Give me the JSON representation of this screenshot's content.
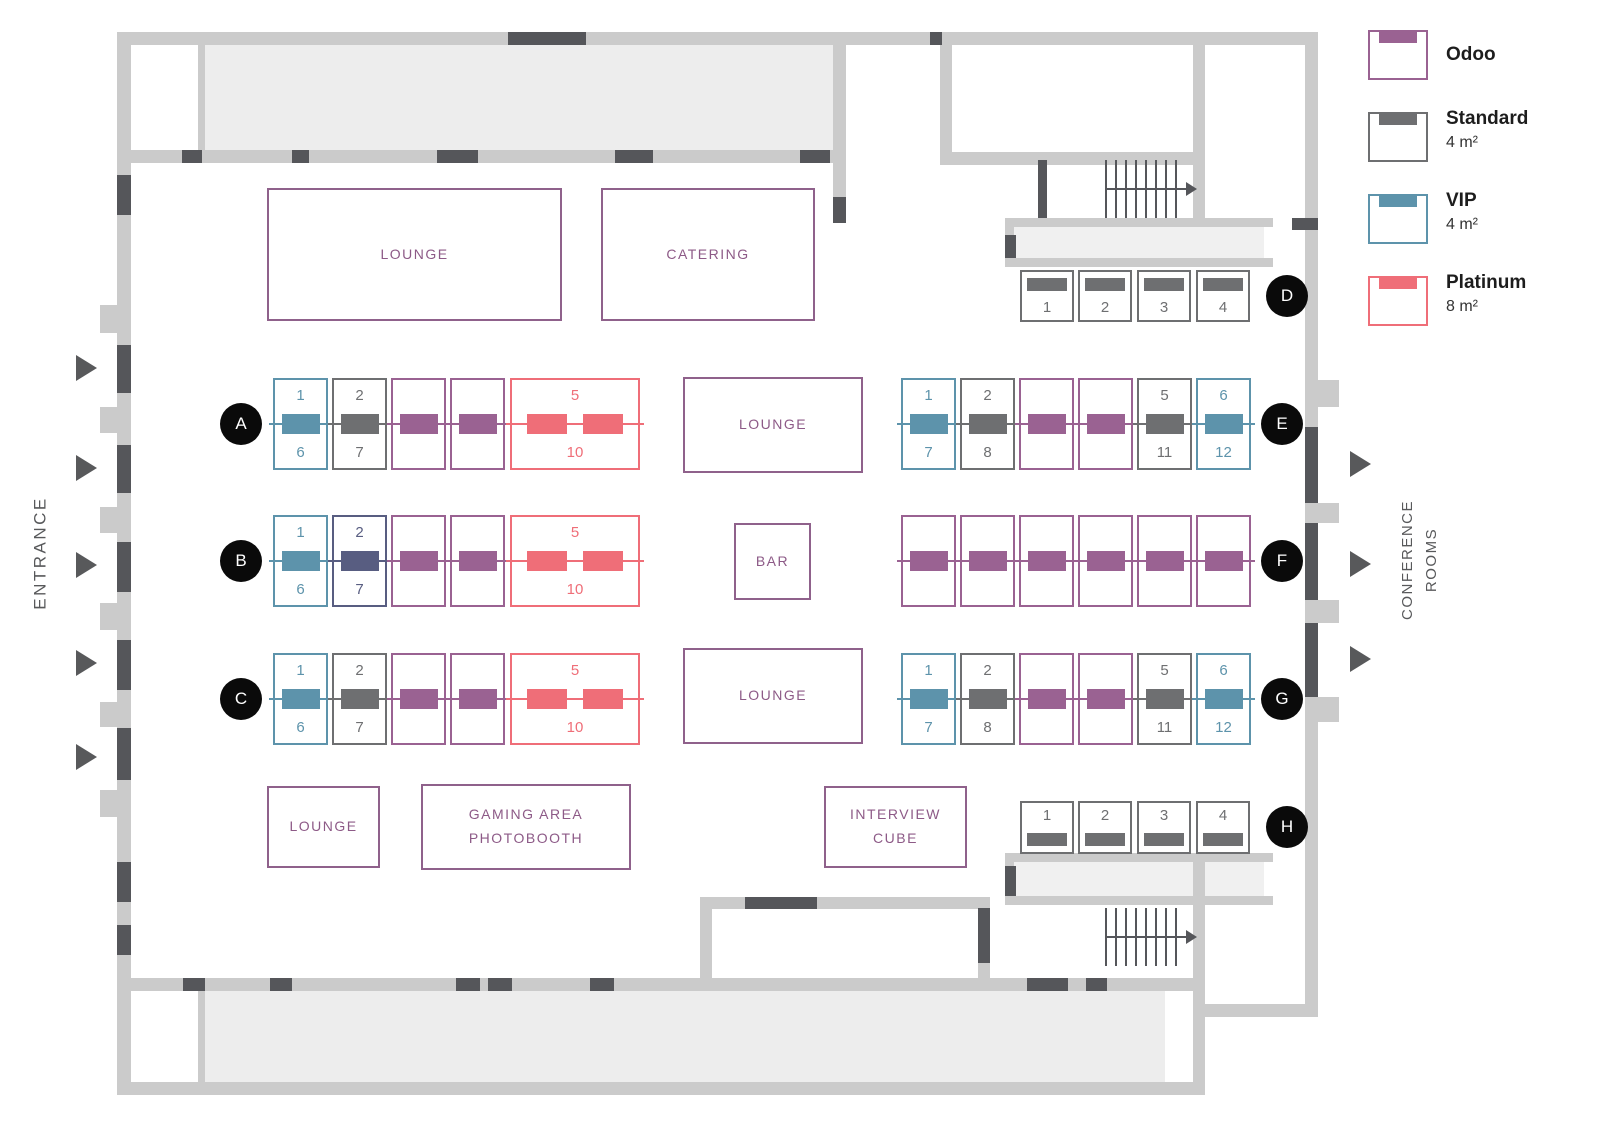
{
  "legend": {
    "items": [
      {
        "id": "odoo",
        "label": "Odoo",
        "size": "",
        "color": "#9a6292"
      },
      {
        "id": "standard",
        "label": "Standard",
        "size": "4 m²",
        "color": "#6e6f71"
      },
      {
        "id": "vip",
        "label": "VIP",
        "size": "4 m²",
        "color": "#5d93ab"
      },
      {
        "id": "platinum",
        "label": "Platinum",
        "size": "8 m²",
        "color": "#ef6e78"
      }
    ]
  },
  "side_labels": {
    "entrance": "ENTRANCE",
    "conference_rooms": "CONFERENCE\nROOMS"
  },
  "booth_colors": {
    "odoo": "#9a6292",
    "standard": "#6e6f71",
    "vip": "#5d93ab",
    "platinum": "#ef6e78",
    "reserved": "#585d81"
  },
  "rooms": [
    {
      "label": "LOUNGE",
      "x": 267,
      "y": 188,
      "w": 295,
      "h": 133
    },
    {
      "label": "CATERING",
      "x": 601,
      "y": 188,
      "w": 214,
      "h": 133
    },
    {
      "label": "LOUNGE",
      "x": 683,
      "y": 377,
      "w": 180,
      "h": 96
    },
    {
      "label": "BAR",
      "x": 734,
      "y": 523,
      "w": 77,
      "h": 77
    },
    {
      "label": "LOUNGE",
      "x": 683,
      "y": 648,
      "w": 180,
      "h": 96
    },
    {
      "label": "LOUNGE",
      "x": 267,
      "y": 786,
      "w": 113,
      "h": 82
    },
    {
      "label": "GAMING AREA\nPHOTOBOOTH",
      "x": 421,
      "y": 784,
      "w": 210,
      "h": 86
    },
    {
      "label": "INTERVIEW\nCUBE",
      "x": 824,
      "y": 786,
      "w": 143,
      "h": 82
    }
  ],
  "rows": [
    {
      "id": "A",
      "badge_x": 241,
      "badge_y": 424,
      "orientation": "v",
      "y": 378,
      "h": 92,
      "booths": [
        {
          "type": "vip",
          "x": 273,
          "w": 55,
          "top": "1",
          "bottom": "6"
        },
        {
          "type": "standard",
          "x": 332,
          "w": 55,
          "top": "2",
          "bottom": "7"
        },
        {
          "type": "odoo",
          "x": 391,
          "w": 55
        },
        {
          "type": "odoo",
          "x": 450,
          "w": 55
        },
        {
          "type": "platinum",
          "x": 510,
          "w": 130,
          "top": "5",
          "bottom": "10",
          "bars": 2
        }
      ]
    },
    {
      "id": "B",
      "badge_x": 241,
      "badge_y": 561,
      "orientation": "v",
      "y": 515,
      "h": 92,
      "booths": [
        {
          "type": "vip",
          "x": 273,
          "w": 55,
          "top": "1",
          "bottom": "6"
        },
        {
          "type": "reserved",
          "x": 332,
          "w": 55,
          "top": "2",
          "bottom": "7"
        },
        {
          "type": "odoo",
          "x": 391,
          "w": 55
        },
        {
          "type": "odoo",
          "x": 450,
          "w": 55
        },
        {
          "type": "platinum",
          "x": 510,
          "w": 130,
          "top": "5",
          "bottom": "10",
          "bars": 2
        }
      ]
    },
    {
      "id": "C",
      "badge_x": 241,
      "badge_y": 699,
      "orientation": "v",
      "y": 653,
      "h": 92,
      "booths": [
        {
          "type": "vip",
          "x": 273,
          "w": 55,
          "top": "1",
          "bottom": "6"
        },
        {
          "type": "standard",
          "x": 332,
          "w": 55,
          "top": "2",
          "bottom": "7"
        },
        {
          "type": "odoo",
          "x": 391,
          "w": 55
        },
        {
          "type": "odoo",
          "x": 450,
          "w": 55
        },
        {
          "type": "platinum",
          "x": 510,
          "w": 130,
          "top": "5",
          "bottom": "10",
          "bars": 2
        }
      ]
    },
    {
      "id": "D",
      "badge_x": 1287,
      "badge_y": 296,
      "orientation": "h",
      "bar_side": "top",
      "y": 270,
      "h": 52,
      "booths": [
        {
          "type": "standard",
          "x": 1020,
          "w": 54,
          "num": "1"
        },
        {
          "type": "standard",
          "x": 1078,
          "w": 54,
          "num": "2"
        },
        {
          "type": "standard",
          "x": 1137,
          "w": 54,
          "num": "3"
        },
        {
          "type": "standard",
          "x": 1196,
          "w": 54,
          "num": "4"
        }
      ]
    },
    {
      "id": "E",
      "badge_x": 1282,
      "badge_y": 424,
      "orientation": "v",
      "y": 378,
      "h": 92,
      "booths": [
        {
          "type": "vip",
          "x": 901,
          "w": 55,
          "top": "1",
          "bottom": "7"
        },
        {
          "type": "standard",
          "x": 960,
          "w": 55,
          "top": "2",
          "bottom": "8"
        },
        {
          "type": "odoo",
          "x": 1019,
          "w": 55
        },
        {
          "type": "odoo",
          "x": 1078,
          "w": 55
        },
        {
          "type": "standard",
          "x": 1137,
          "w": 55,
          "top": "5",
          "bottom": "11"
        },
        {
          "type": "vip",
          "x": 1196,
          "w": 55,
          "top": "6",
          "bottom": "12"
        }
      ]
    },
    {
      "id": "F",
      "badge_x": 1282,
      "badge_y": 561,
      "orientation": "v",
      "y": 515,
      "h": 92,
      "booths": [
        {
          "type": "odoo",
          "x": 901,
          "w": 55
        },
        {
          "type": "odoo",
          "x": 960,
          "w": 55
        },
        {
          "type": "odoo",
          "x": 1019,
          "w": 55
        },
        {
          "type": "odoo",
          "x": 1078,
          "w": 55
        },
        {
          "type": "odoo",
          "x": 1137,
          "w": 55
        },
        {
          "type": "odoo",
          "x": 1196,
          "w": 55
        }
      ]
    },
    {
      "id": "G",
      "badge_x": 1282,
      "badge_y": 699,
      "orientation": "v",
      "y": 653,
      "h": 92,
      "booths": [
        {
          "type": "vip",
          "x": 901,
          "w": 55,
          "top": "1",
          "bottom": "7"
        },
        {
          "type": "standard",
          "x": 960,
          "w": 55,
          "top": "2",
          "bottom": "8"
        },
        {
          "type": "odoo",
          "x": 1019,
          "w": 55
        },
        {
          "type": "odoo",
          "x": 1078,
          "w": 55
        },
        {
          "type": "standard",
          "x": 1137,
          "w": 55,
          "top": "5",
          "bottom": "11"
        },
        {
          "type": "vip",
          "x": 1196,
          "w": 55,
          "top": "6",
          "bottom": "12"
        }
      ]
    },
    {
      "id": "H",
      "badge_x": 1287,
      "badge_y": 827,
      "orientation": "h",
      "bar_side": "bottom",
      "y": 801,
      "h": 53,
      "booths": [
        {
          "type": "standard",
          "x": 1020,
          "w": 54,
          "num": "1"
        },
        {
          "type": "standard",
          "x": 1078,
          "w": 54,
          "num": "2"
        },
        {
          "type": "standard",
          "x": 1137,
          "w": 54,
          "num": "3"
        },
        {
          "type": "standard",
          "x": 1196,
          "w": 54,
          "num": "4"
        }
      ]
    }
  ]
}
